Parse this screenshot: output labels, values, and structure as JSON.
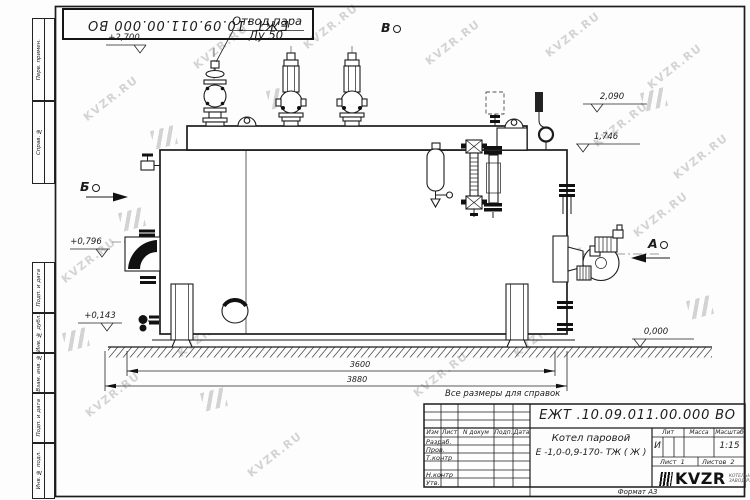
{
  "watermark": {
    "text": "KVZR.RU"
  },
  "stamp": {
    "number": "ЕЖТ .10.09.011.00.000  ВО"
  },
  "frame": {
    "side_labels": [
      "Перв. примен.",
      "Справ. №",
      "Подп. и дата",
      "Инв. № дубл.",
      "Взам. инв. №",
      "Подп. и дата",
      "Инв. № подл."
    ]
  },
  "annotations": {
    "steam_outlet_line1": "Отвод пара",
    "steam_outlet_line2": "Ду 50",
    "elev_top": "+2,700",
    "view_top": "В",
    "elev_2090": "2,090",
    "elev_1746": "1,746",
    "view_left": "Б",
    "elev_0796": "+0,796",
    "elev_0143": "+0,143",
    "view_right": "А",
    "elev_zero": "0,000",
    "dim_3600": "3600",
    "dim_3880": "3880",
    "ref_note": "Все размеры для справок"
  },
  "title_block": {
    "doc_number": "ЕЖТ .10.09.011.00.000  ВО",
    "product_name_line1": "Котел паровой",
    "product_name_line2": "Е -1,0-0,9-170- ТЖ ( Ж )",
    "header_izm": "Изм",
    "header_list": "Лист",
    "header_ndokum": "N докум",
    "header_podp": "Подп.",
    "header_data": "Дата",
    "rows": [
      "Разраб.",
      "Пров.",
      "Т.контр",
      "",
      "Н.контр",
      "Утв."
    ],
    "lit_label": "Лит",
    "mass_label": "Масса",
    "scale_label": "Масштаб",
    "lit_value": "И",
    "scale_value": "1:15",
    "sheet_label": "Лист",
    "sheet_value": "1",
    "sheets_label": "Листов",
    "sheets_value": "2",
    "logo_text": "KVZR",
    "logo_sub_line1": "КОТЕЛЬНЫЙ",
    "logo_sub_line2": "ЗАВОД РЭ",
    "format_label": "Формат  А3"
  }
}
